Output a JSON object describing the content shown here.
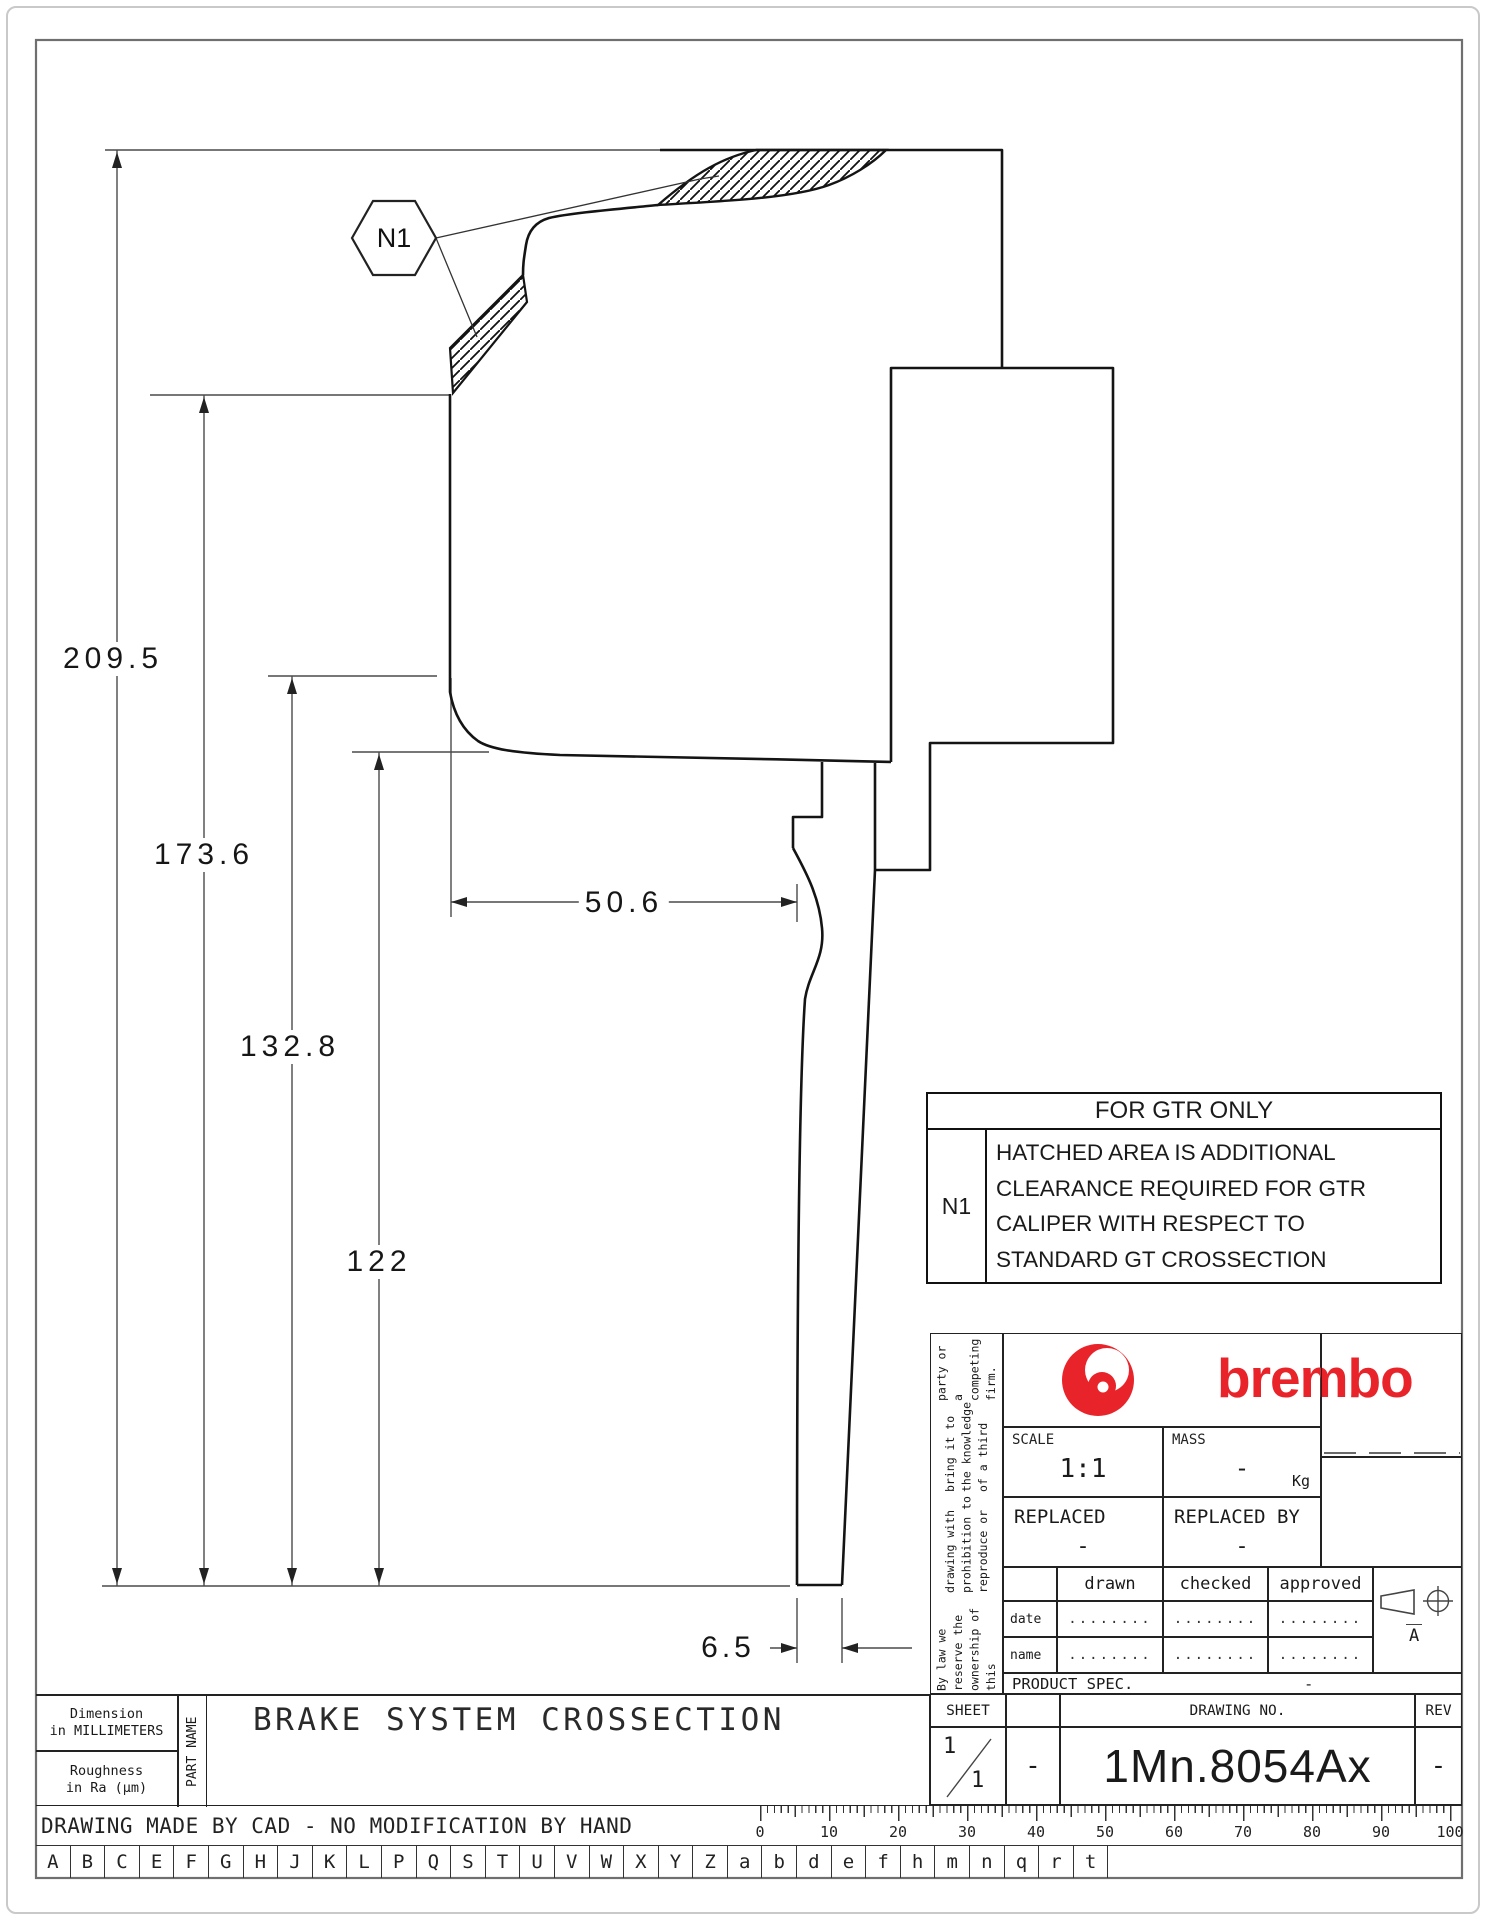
{
  "dims": {
    "total": "209.5",
    "mid": "173.6",
    "inner": "132.8",
    "low": "122",
    "width": "50.6",
    "thickness": "6.5"
  },
  "callout": {
    "label": "N1"
  },
  "note_table": {
    "title": "FOR GTR ONLY",
    "ref": "N1",
    "line1": "HATCHED AREA IS ADDITIONAL",
    "line2": "CLEARANCE REQUIRED FOR GTR",
    "line3": "CALIPER WITH RESPECT TO",
    "line4": "STANDARD GT CROSSECTION"
  },
  "title_block": {
    "brand": "brembo",
    "brand_color": "#e8232a",
    "legal1": "By law we reserve the ownership of this",
    "legal2": "drawing with prohibition to reproduce or",
    "legal3": "bring it to the knowledge of a third",
    "legal4": "party or a competing firm.",
    "scale_label": "SCALE",
    "scale_value": "1:1",
    "mass_label": "MASS",
    "mass_value": "-",
    "mass_unit": "Kg",
    "replaced_label": "REPLACED",
    "replaced_value": "-",
    "replaced_by_label": "REPLACED BY",
    "replaced_by_value": "-",
    "drawn_label": "drawn",
    "checked_label": "checked",
    "approved_label": "approved",
    "date_label": "date",
    "name_label": "name",
    "dots": "........",
    "format_letter": "A",
    "product_spec_label": "PRODUCT SPEC.",
    "product_spec_value": "-",
    "sheet_label": "SHEET",
    "sheet_num": "1",
    "sheet_den": "1",
    "sheet_extra": "-",
    "drawing_no_label": "DRAWING NO.",
    "drawing_no": "1Mn.8054Ax",
    "rev_label": "REV",
    "rev_value": "-"
  },
  "footer": {
    "dim_note1": "Dimension",
    "dim_note2": "in MILLIMETERS",
    "rough_note1": "Roughness",
    "rough_note2": "in Ra (µm)",
    "part_name_label": "PART NAME",
    "part_name": "BRAKE SYSTEM CROSSECTION",
    "cad_note": "DRAWING MADE BY CAD - NO MODIFICATION BY HAND",
    "ruler": [
      "0",
      "10",
      "20",
      "30",
      "40",
      "50",
      "60",
      "70",
      "80",
      "90",
      "100"
    ],
    "letters": [
      "A",
      "B",
      "C",
      "E",
      "F",
      "G",
      "H",
      "J",
      "K",
      "L",
      "P",
      "Q",
      "S",
      "T",
      "U",
      "V",
      "W",
      "X",
      "Y",
      "Z",
      "a",
      "b",
      "d",
      "e",
      "f",
      "h",
      "m",
      "n",
      "q",
      "r",
      "t"
    ]
  }
}
